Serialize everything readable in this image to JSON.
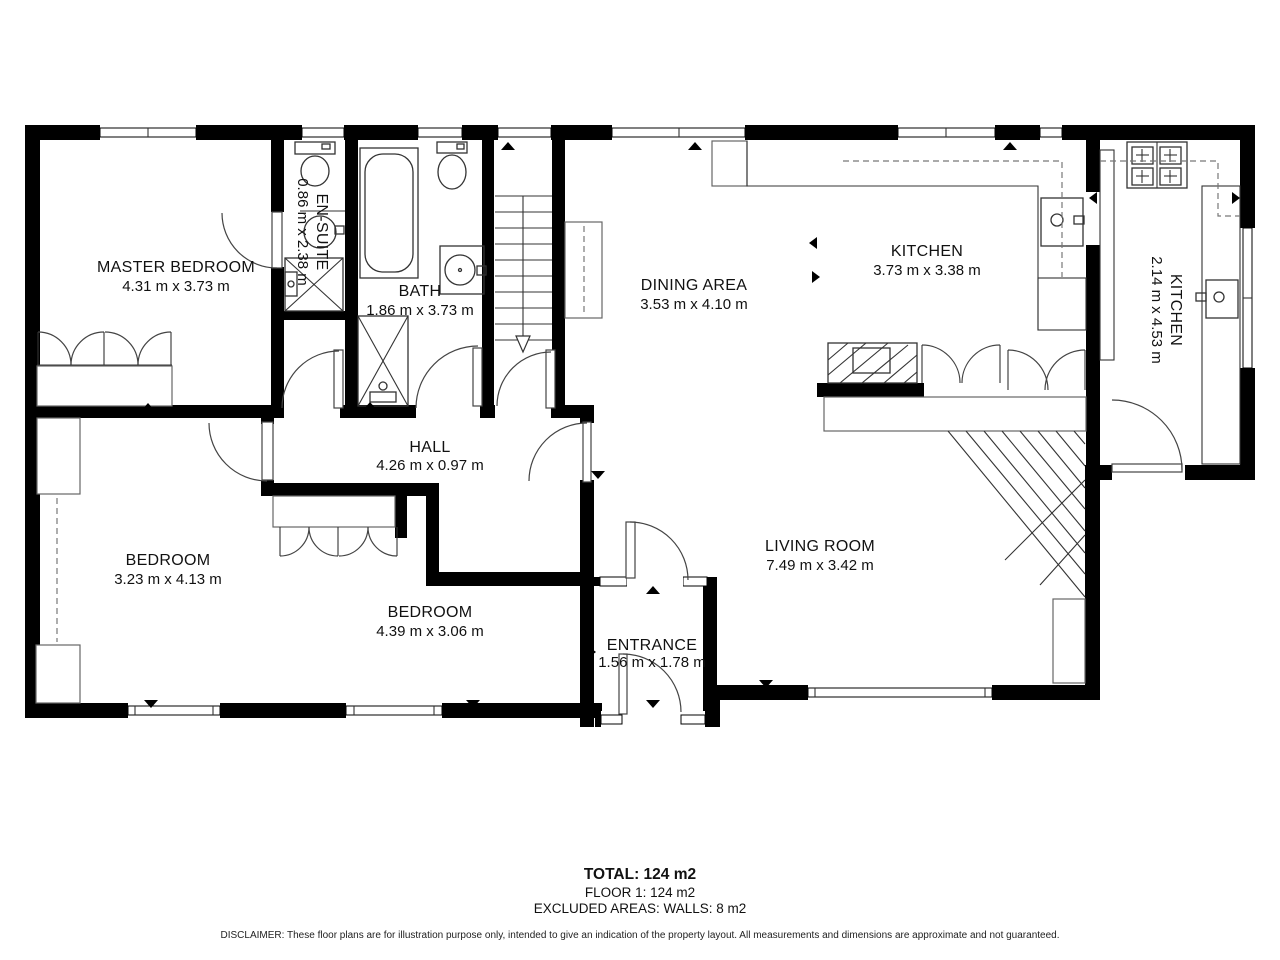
{
  "plan": {
    "rooms": {
      "master_bedroom": {
        "name": "MASTER BEDROOM",
        "dims": "4.31 m x 3.73 m"
      },
      "ensuite": {
        "name": "EN-SUITE",
        "dims": "0.86 m x 2.38 m"
      },
      "bath": {
        "name": "BATH",
        "dims": "1.86 m x 3.73 m"
      },
      "dining_area": {
        "name": "DINING AREA",
        "dims": "3.53 m x 4.10 m"
      },
      "kitchen": {
        "name": "KITCHEN",
        "dims": "3.73 m x 3.38 m"
      },
      "kitchen_2": {
        "name": "KITCHEN",
        "dims": "2.14 m x 4.53 m"
      },
      "hall": {
        "name": "HALL",
        "dims": "4.26 m x 0.97 m"
      },
      "bedroom_left": {
        "name": "BEDROOM",
        "dims": "3.23 m x 4.13 m"
      },
      "bedroom_middle": {
        "name": "BEDROOM",
        "dims": "4.39 m x 3.06 m"
      },
      "entrance": {
        "name": "ENTRANCE",
        "dims": "1.56 m x 1.78 m"
      },
      "living_room": {
        "name": "LIVING ROOM",
        "dims": "7.49 m x 3.42 m"
      }
    },
    "summary": {
      "total": "TOTAL: 124 m2",
      "floor": "FLOOR 1: 124 m2",
      "excluded": "EXCLUDED AREAS: WALLS: 8 m2"
    },
    "disclaimer": "DISCLAIMER: These floor plans are for illustration purpose only, intended to give an indication of the property layout. All measurements and dimensions are approximate and not guaranteed.",
    "colors": {
      "wall": "#000000",
      "background": "#ffffff",
      "text": "#111111"
    }
  }
}
